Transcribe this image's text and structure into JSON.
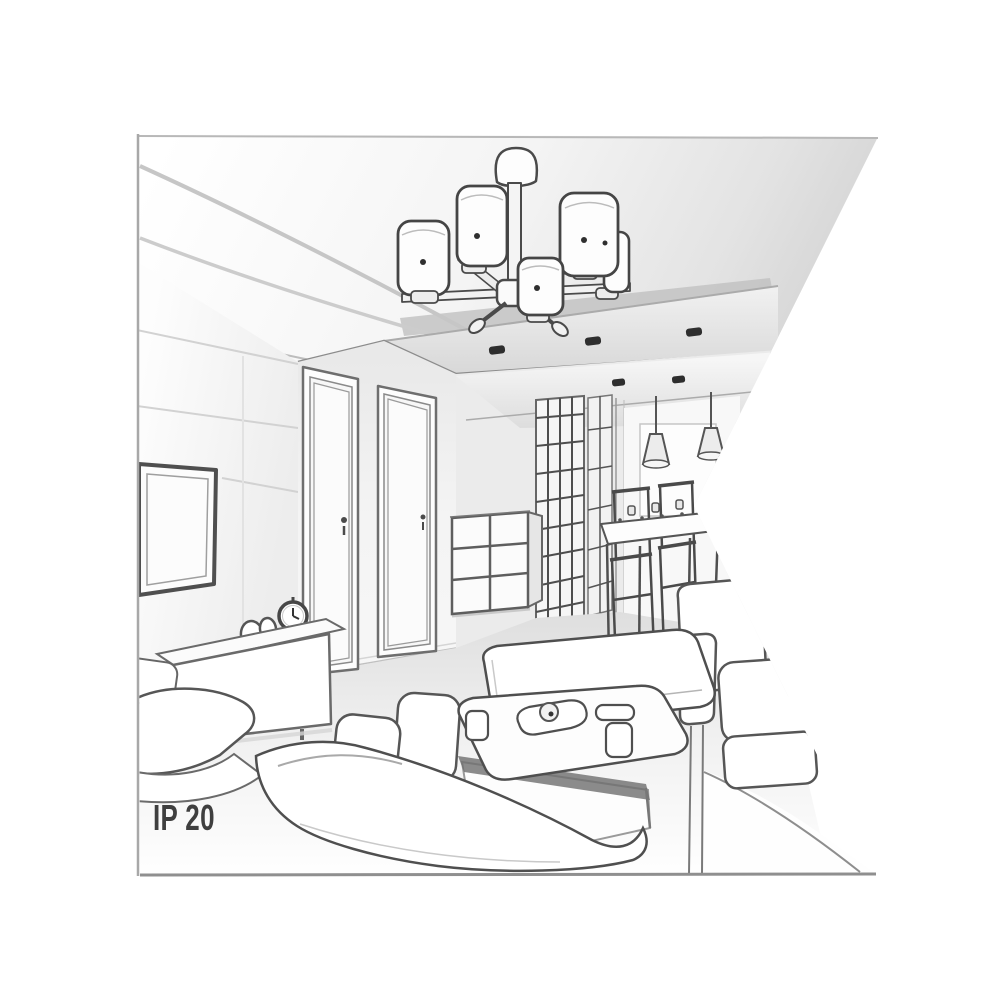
{
  "page": {
    "background": "#ffffff"
  },
  "label": {
    "text": "IP 20",
    "color": "#3f3f3f"
  },
  "illustration": {
    "description": "Grayscale perspective line drawing of a living room interior seen toward a hallway, with a five-shade ceiling chandelier on a recessed ceiling panel, recessed spotlights, paneled TV wall with wall-mounted TV, low sideboard with alarm clock and remote, two interior doors, grid-front drawer cabinet, lattice wardrobe, dining table with chairs and two cone pendant lights, two white sofas, an ottoman and a coffee table with cups and a tray; the right edge of the picture is cut by a triangular notch",
    "style": "pencil-sketch line art",
    "colors": {
      "line_dark": "#4a4a4a",
      "line_mid": "#8c8c8c",
      "line_light": "#c6c6c6",
      "fill_white": "#ffffff",
      "fill_light": "#f2f2f2",
      "fill_mid": "#dddddd",
      "ceiling_shade": "#cdcdcd",
      "spotlight": "#2e2e2e",
      "text": "#3f3f3f"
    },
    "elements": [
      "ceiling-recess",
      "chandelier",
      "recessed-spotlights",
      "left-wall-panels",
      "wall-tv",
      "sideboard",
      "alarm-clock",
      "remote-control",
      "interior-doors",
      "drawer-cabinet",
      "hallway-wardrobe",
      "dining-table",
      "dining-chairs",
      "pendant-lights",
      "ottoman",
      "coffee-table",
      "sofas"
    ]
  }
}
